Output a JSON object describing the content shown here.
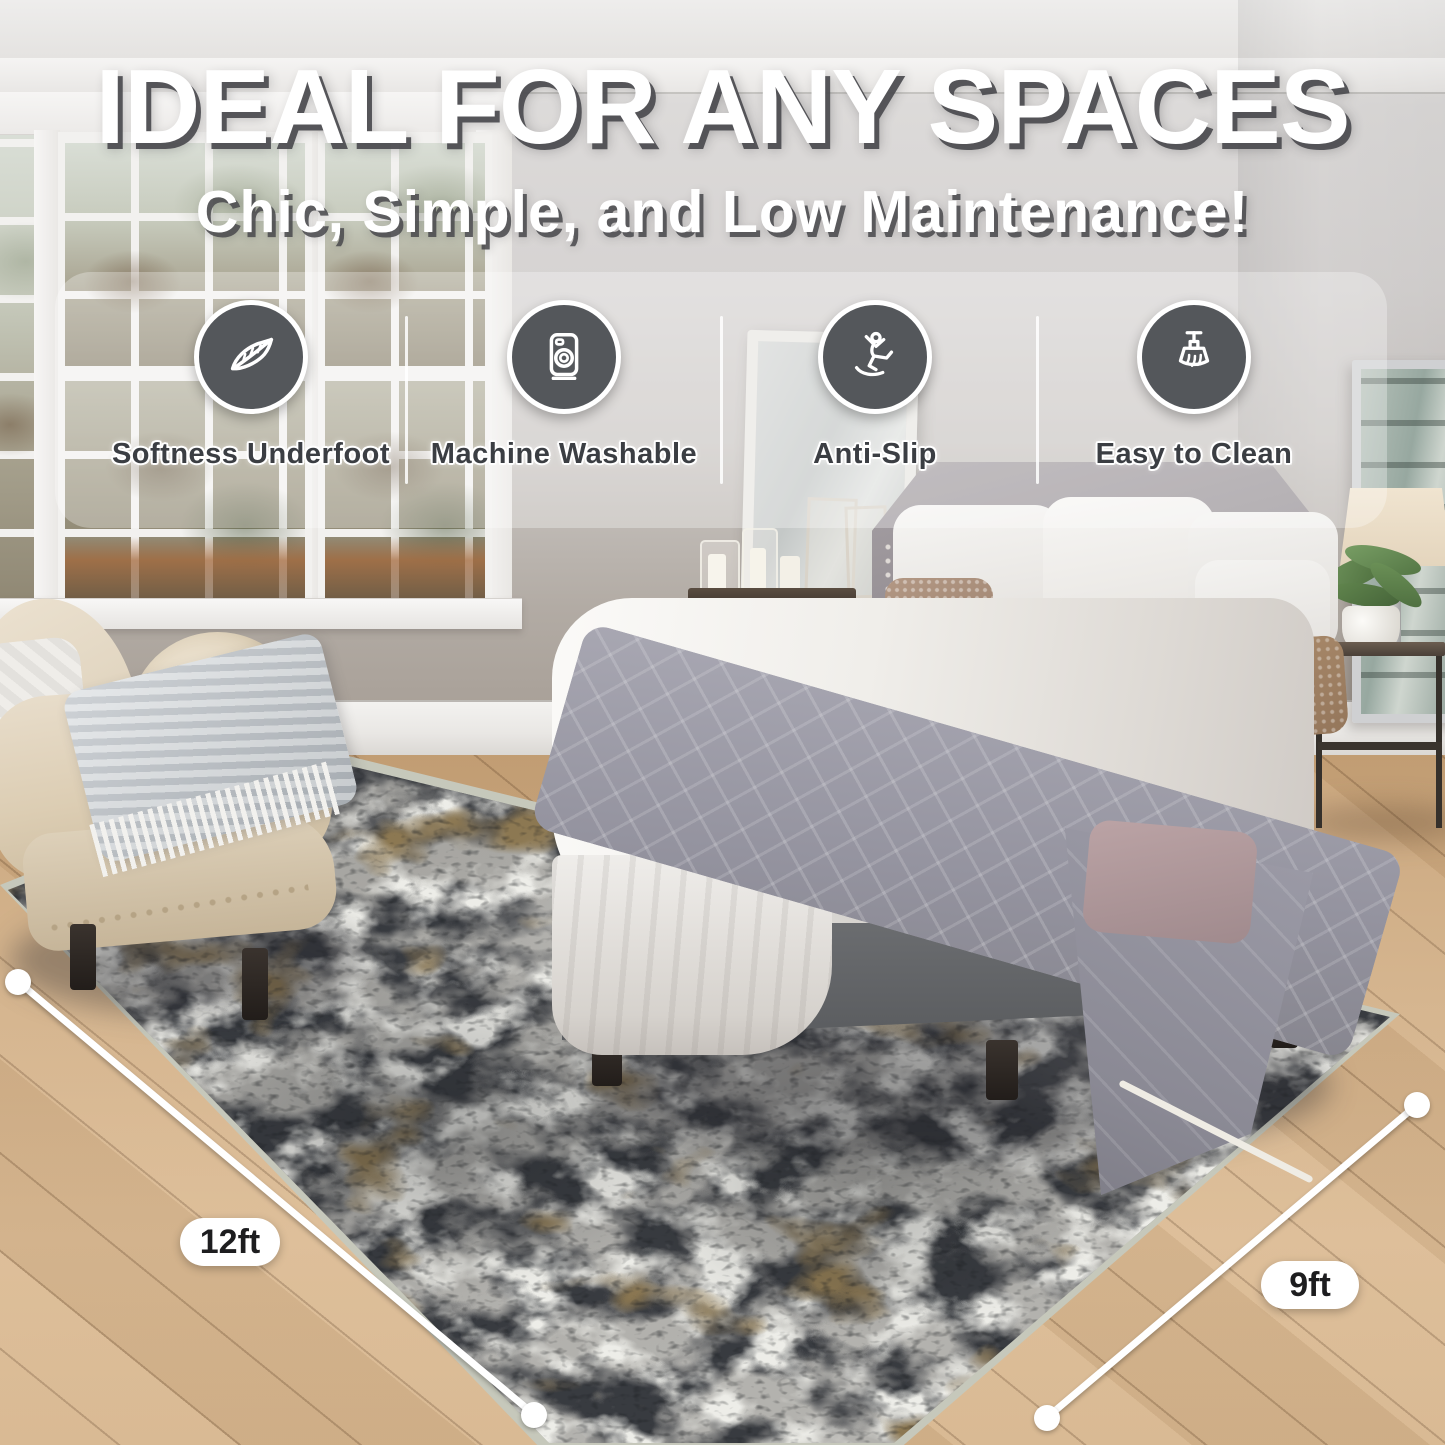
{
  "title": "IDEAL FOR ANY SPACES",
  "subtitle": "Chic, Simple, and Low Maintenance!",
  "features": [
    {
      "label": "Softness Underfoot",
      "icon": "feather-icon"
    },
    {
      "label": "Machine Washable",
      "icon": "washing-machine-icon"
    },
    {
      "label": "Anti-Slip",
      "icon": "anti-slip-icon"
    },
    {
      "label": "Easy to Clean",
      "icon": "cleaning-brush-icon"
    }
  ],
  "dimensions": {
    "length": "12ft",
    "width": "9ft"
  },
  "colors": {
    "icon_circle": "#54575b",
    "title_text": "#ffffff",
    "title_shadow": "#4b4b4f",
    "label_text": "#3b3e43",
    "rug_binding": "#c6c8bb",
    "floor_wood": "#d0ac81",
    "wall": "#d5d2d0",
    "dimension_marker": "#ffffff"
  }
}
